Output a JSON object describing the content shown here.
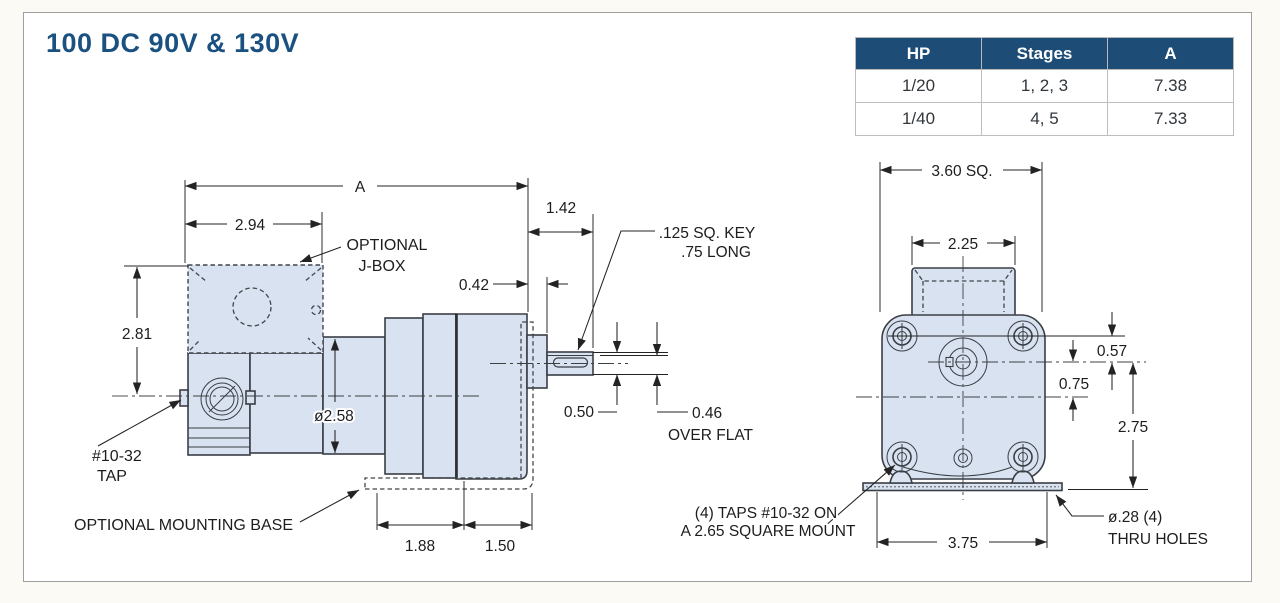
{
  "page": {
    "title": "100 DC 90V & 130V"
  },
  "table": {
    "headers": [
      "HP",
      "Stages",
      "A"
    ],
    "rows": [
      [
        "1/20",
        "1, 2, 3",
        "7.38"
      ],
      [
        "1/40",
        "4, 5",
        "7.33"
      ]
    ]
  },
  "side_view": {
    "dim_a": "A",
    "dim_294": "2.94",
    "dim_142": "1.42",
    "dim_042": "0.42",
    "dim_281": "2.81",
    "dim_258": "ø2.58",
    "dim_050": "0.50",
    "dim_046": "0.46",
    "over_flat": "OVER FLAT",
    "key_line1": ".125 SQ. KEY",
    "key_line2": ".75 LONG",
    "tap_line1": "#10-32",
    "tap_line2": "TAP",
    "jbox_line1": "OPTIONAL",
    "jbox_line2": "J-BOX",
    "base_label": "OPTIONAL MOUNTING BASE",
    "dim_188": "1.88",
    "dim_150": "1.50"
  },
  "front_view": {
    "dim_360": "3.60 SQ.",
    "dim_225": "2.25",
    "dim_057": "0.57",
    "dim_075": "0.75",
    "dim_275": "2.75",
    "dim_375": "3.75",
    "taps_line1": "(4) TAPS #10-32 ON",
    "taps_line2": "A 2.65 SQUARE MOUNT",
    "holes_line1": "ø.28 (4)",
    "holes_line2": "THRU HOLES"
  },
  "colors": {
    "title_blue": "#1b5180",
    "table_header_bg": "#1d4d77",
    "part_fill": "#d8e2f0",
    "outline": "#3a3e45"
  }
}
